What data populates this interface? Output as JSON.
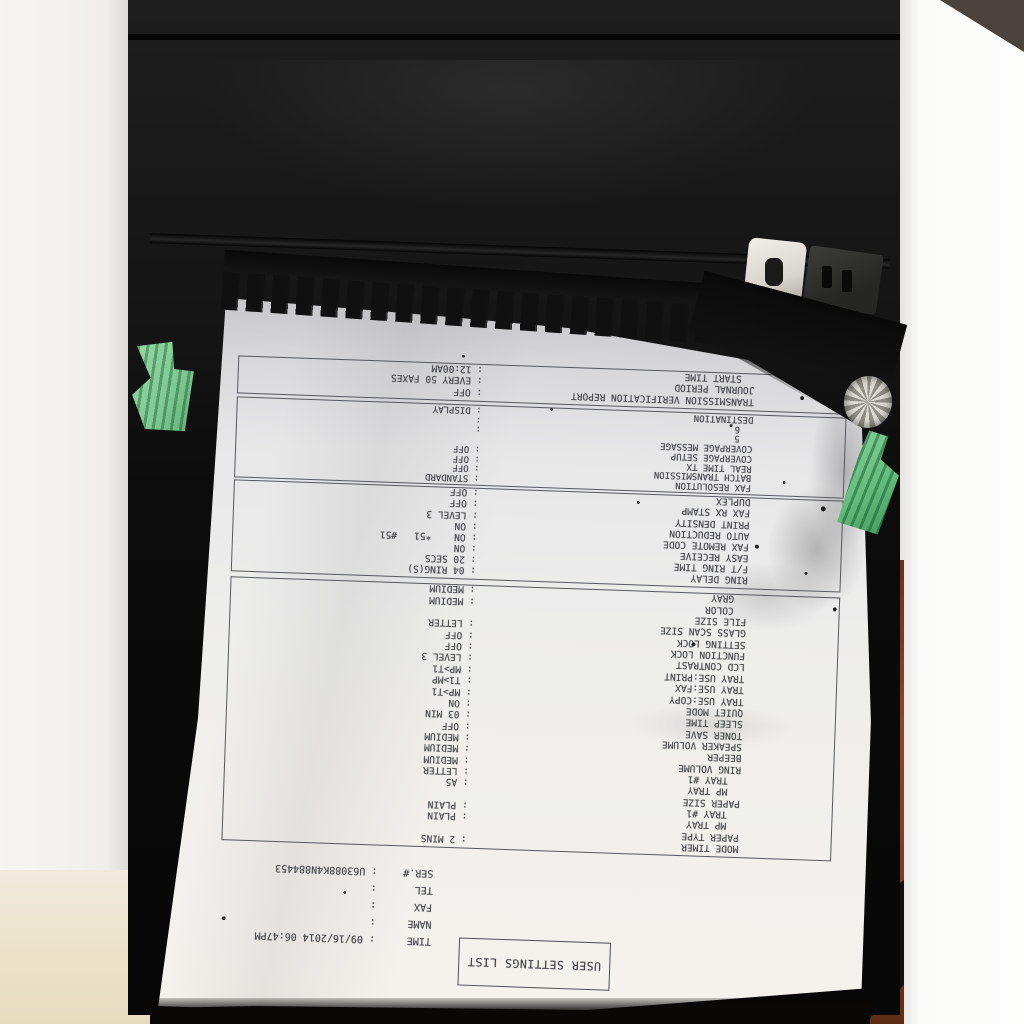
{
  "scene": {
    "description": "Photograph of a dark laser printer with a printed settings report emerging upside-down from the output slot",
    "colors": {
      "printer_black": "#141414",
      "paper_white": "#ececec",
      "ink_gray": "#4a4c50",
      "lever_green": "#7fca92",
      "wall_white": "#f5f4f1",
      "wood_brown": "#7c3c20"
    }
  },
  "document": {
    "title": "USER SETTINGS LIST",
    "info": [
      {
        "label": "TIME",
        "value": ": 09/16/2014 06:47PM"
      },
      {
        "label": "NAME",
        "value": ":"
      },
      {
        "label": "FAX",
        "value": ":"
      },
      {
        "label": "TEL",
        "value": ":"
      },
      {
        "label": "SER.#",
        "value": ": U63088K4N884453"
      }
    ],
    "sections": [
      {
        "rows": [
          {
            "label": "MODE TIMER",
            "value": ": 2 MINS",
            "indent": 0
          },
          {
            "label": "PAPER TYPE",
            "value": "",
            "indent": 0
          },
          {
            "label": "MP TRAY",
            "value": ": PLAIN",
            "indent": 1
          },
          {
            "label": "TRAY #1",
            "value": ": PLAIN",
            "indent": 1
          },
          {
            "label": "PAPER SIZE",
            "value": "",
            "indent": 0
          },
          {
            "label": "MP TRAY",
            "value": ": A5",
            "indent": 1
          },
          {
            "label": "TRAY #1",
            "value": ": LETTER",
            "indent": 1
          },
          {
            "label": "RING VOLUME",
            "value": ": MEDIUM",
            "indent": 0
          },
          {
            "label": "BEEPER",
            "value": ": MEDIUM",
            "indent": 0
          },
          {
            "label": "SPEAKER VOLUME",
            "value": ": MEDIUM",
            "indent": 0
          },
          {
            "label": "TONER SAVE",
            "value": ": OFF",
            "indent": 0
          },
          {
            "label": "SLEEP TIME",
            "value": ": 03 MIN",
            "indent": 0
          },
          {
            "label": "QUIET MODE",
            "value": ": ON",
            "indent": 0
          },
          {
            "label": "TRAY USE:COPY",
            "value": ": MP>T1",
            "indent": 0
          },
          {
            "label": "TRAY USE:FAX",
            "value": ": T1>MP",
            "indent": 0
          },
          {
            "label": "TRAY USE:PRINT",
            "value": ": MP>T1",
            "indent": 0
          },
          {
            "label": "LCD CONTRAST",
            "value": ": LEVEL 3",
            "indent": 0
          },
          {
            "label": "FUNCTION LOCK",
            "value": ": OFF",
            "indent": 0
          },
          {
            "label": "SETTING LOCK",
            "value": ": OFF",
            "indent": 0
          },
          {
            "label": "GLASS SCAN SIZE",
            "value": ": LETTER",
            "indent": 0
          },
          {
            "label": "FILE SIZE",
            "value": "",
            "indent": 0
          },
          {
            "label": "COLOR",
            "value": ": MEDIUM",
            "indent": 1
          },
          {
            "label": "GRAY",
            "value": ": MEDIUM",
            "indent": 1
          }
        ]
      },
      {
        "rows": [
          {
            "label": "RING DELAY",
            "value": ": 04 RING(S)",
            "indent": 0
          },
          {
            "label": "F/T RING TIME",
            "value": ": 20 SECS",
            "indent": 0
          },
          {
            "label": "EASY RECEIVE",
            "value": ": ON",
            "indent": 0
          },
          {
            "label": "FAX REMOTE CODE",
            "value": ": ON    *51   #51",
            "indent": 0
          },
          {
            "label": "AUTO REDUCTION",
            "value": ": ON",
            "indent": 0
          },
          {
            "label": "PRINT DENSITY",
            "value": ": LEVEL 3",
            "indent": 0
          },
          {
            "label": "FAX RX STAMP",
            "value": ": OFF",
            "indent": 0
          },
          {
            "label": "DUPLEX",
            "value": ": OFF",
            "indent": 0
          }
        ]
      },
      {
        "rows": [
          {
            "label": "FAX RESOLUTION",
            "value": ": STANDARD",
            "indent": 0
          },
          {
            "label": "BATCH TRANSMISSION",
            "value": ": OFF",
            "indent": 0
          },
          {
            "label": "REAL TIME TX",
            "value": ": OFF",
            "indent": 0
          },
          {
            "label": "COVERPAGE SETUP",
            "value": ": OFF",
            "indent": 0
          },
          {
            "label": "COVERPAGE MESSAGE",
            "value": "",
            "indent": 0
          },
          {
            "label": "5",
            "value": ":",
            "indent": 1
          },
          {
            "label": "6",
            "value": ":",
            "indent": 1
          },
          {
            "label": "DESTINATION",
            "value": ": DISPLAY",
            "indent": 0
          }
        ]
      },
      {
        "rows": [
          {
            "label": "TRANSMISSION VERIFICATION REPORT",
            "value": ": OFF",
            "indent": 0
          },
          {
            "label": "JOURNAL PERIOD",
            "value": ": EVERY 50 FAXES",
            "indent": 0
          },
          {
            "label": "START TIME",
            "value": ": 12:00AM",
            "indent": 1
          }
        ]
      }
    ]
  }
}
